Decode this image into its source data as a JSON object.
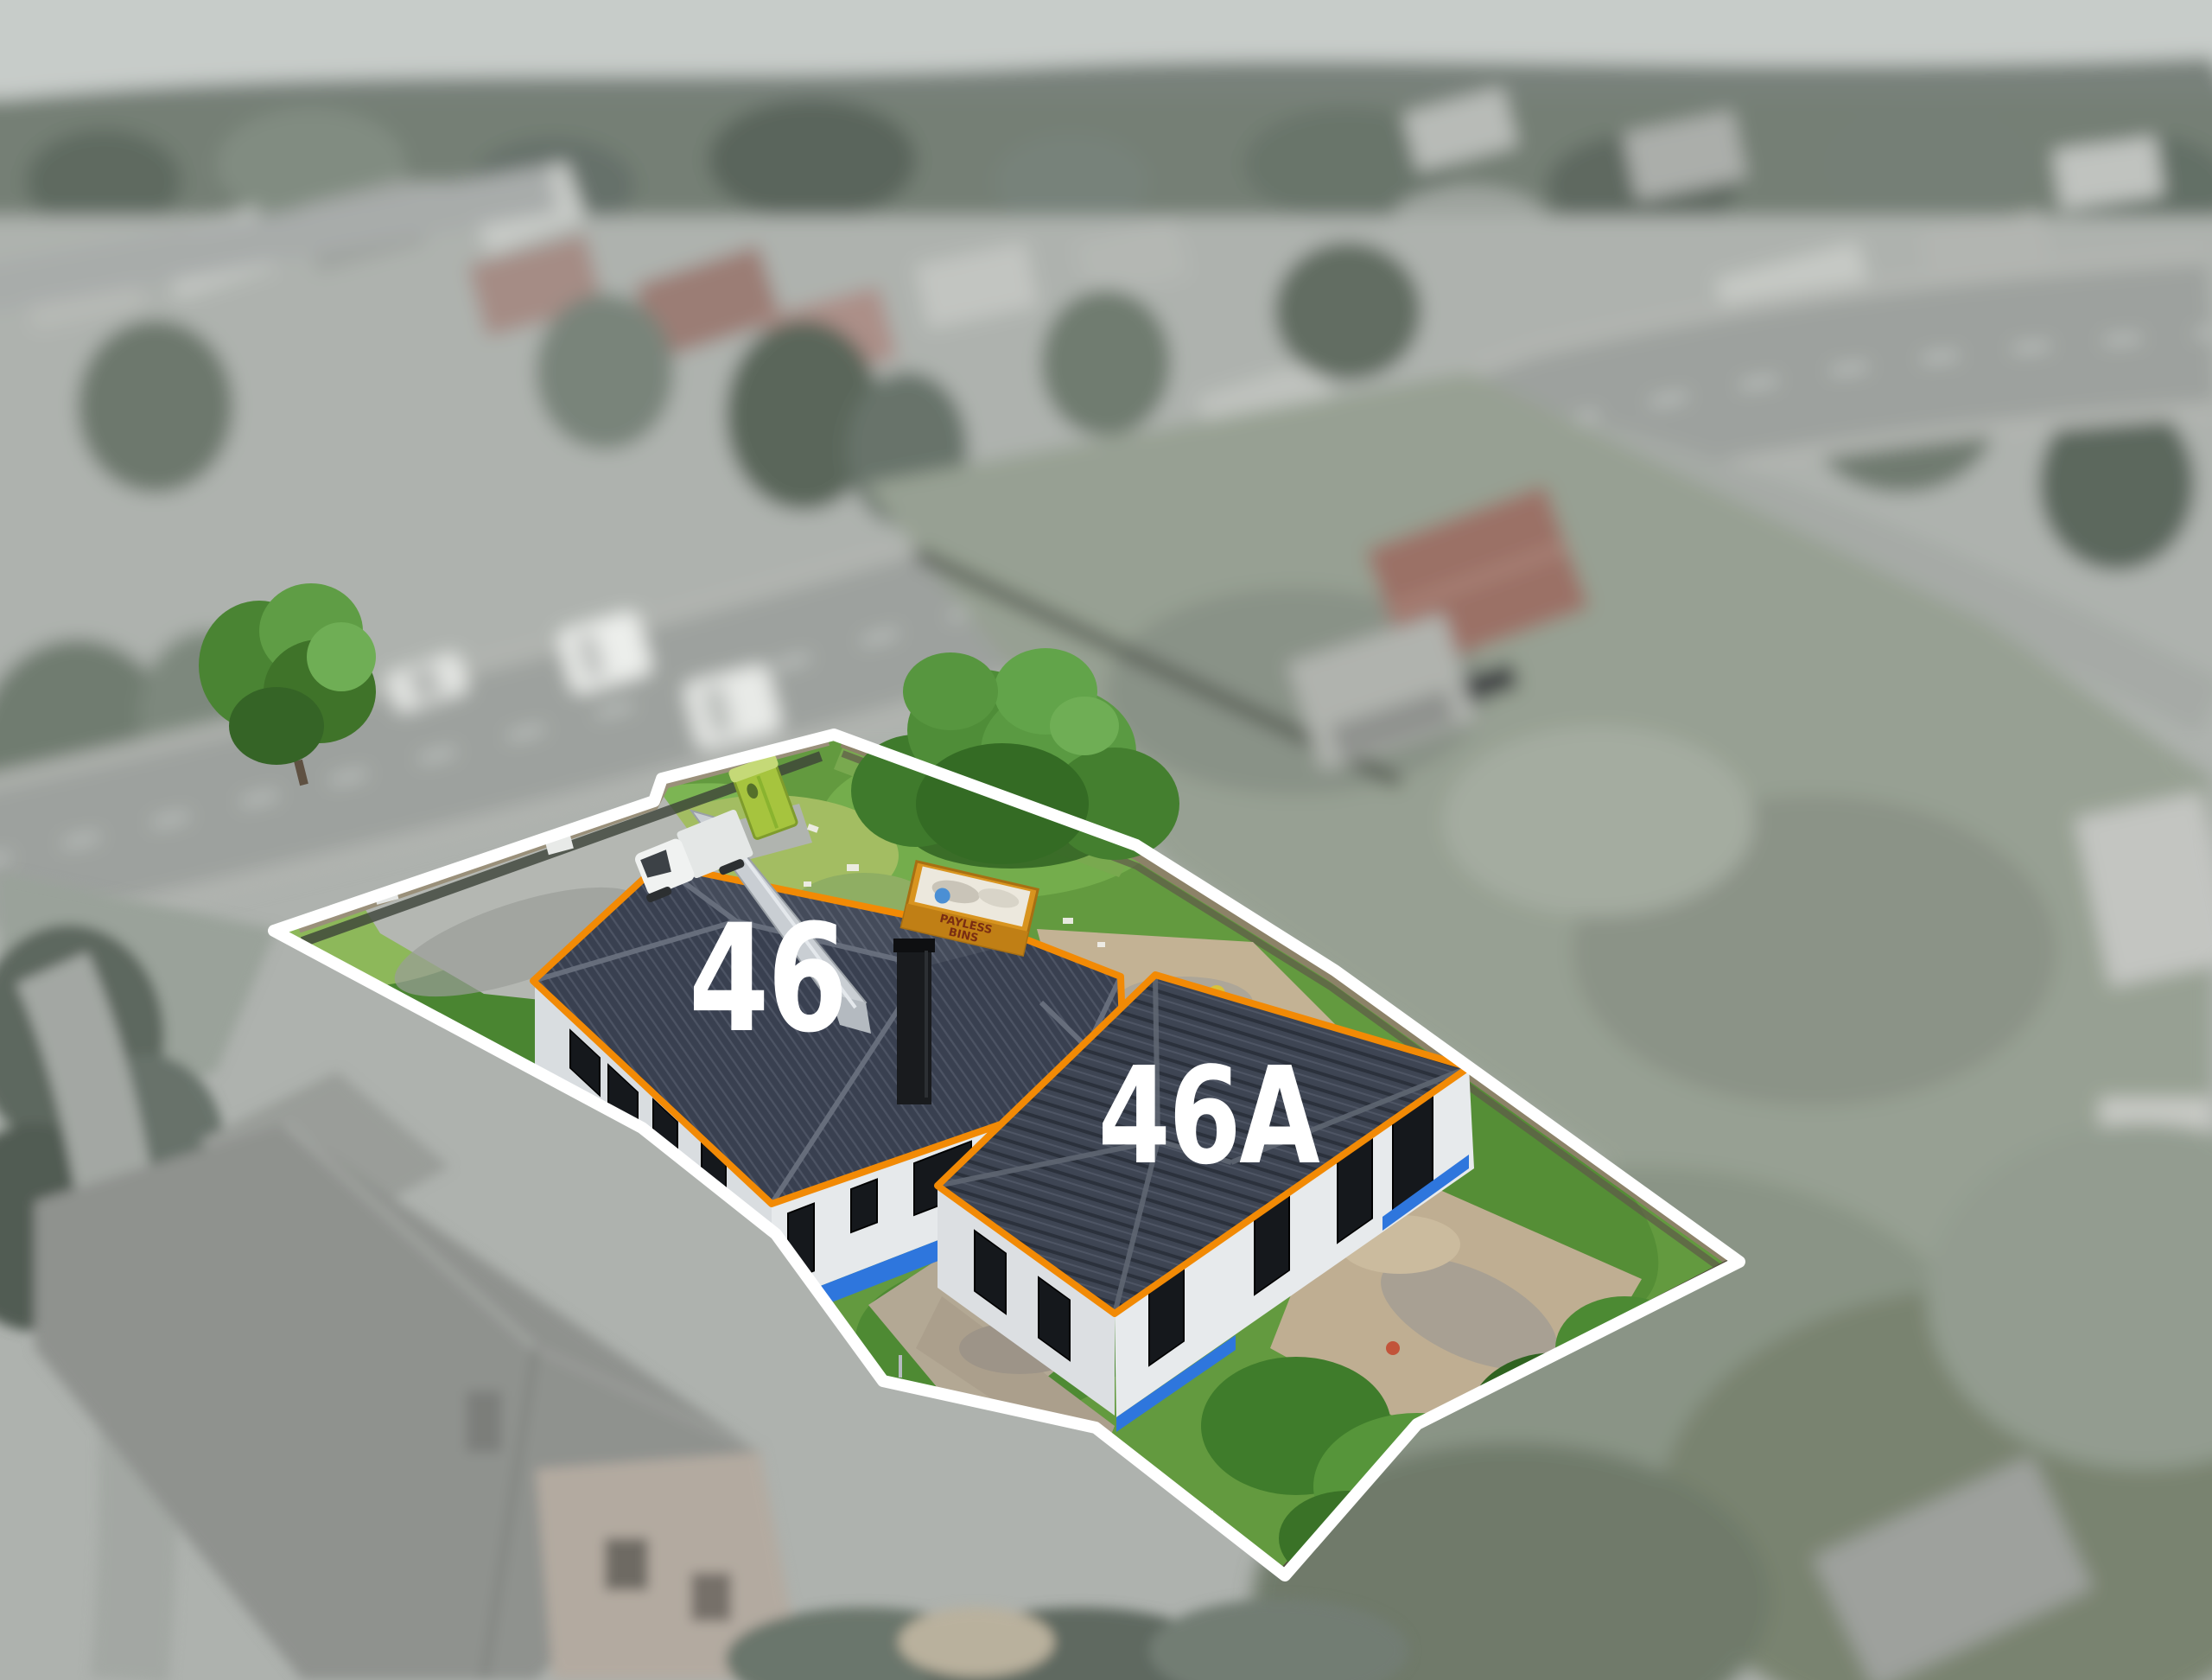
{
  "scene": {
    "lot_labels": {
      "front": "46",
      "rear": "46A"
    },
    "skip_bin": {
      "line1": "PAYLESS",
      "line2": "BINS"
    },
    "colors": {
      "boundary_line": "#ffffff",
      "roof_outline": "#f28a05",
      "label_text": "#ffffff",
      "skip_bin_body": "#d8941f",
      "foundation_wrap": "#2e76dd",
      "portaloo": "#a6c43e"
    }
  }
}
